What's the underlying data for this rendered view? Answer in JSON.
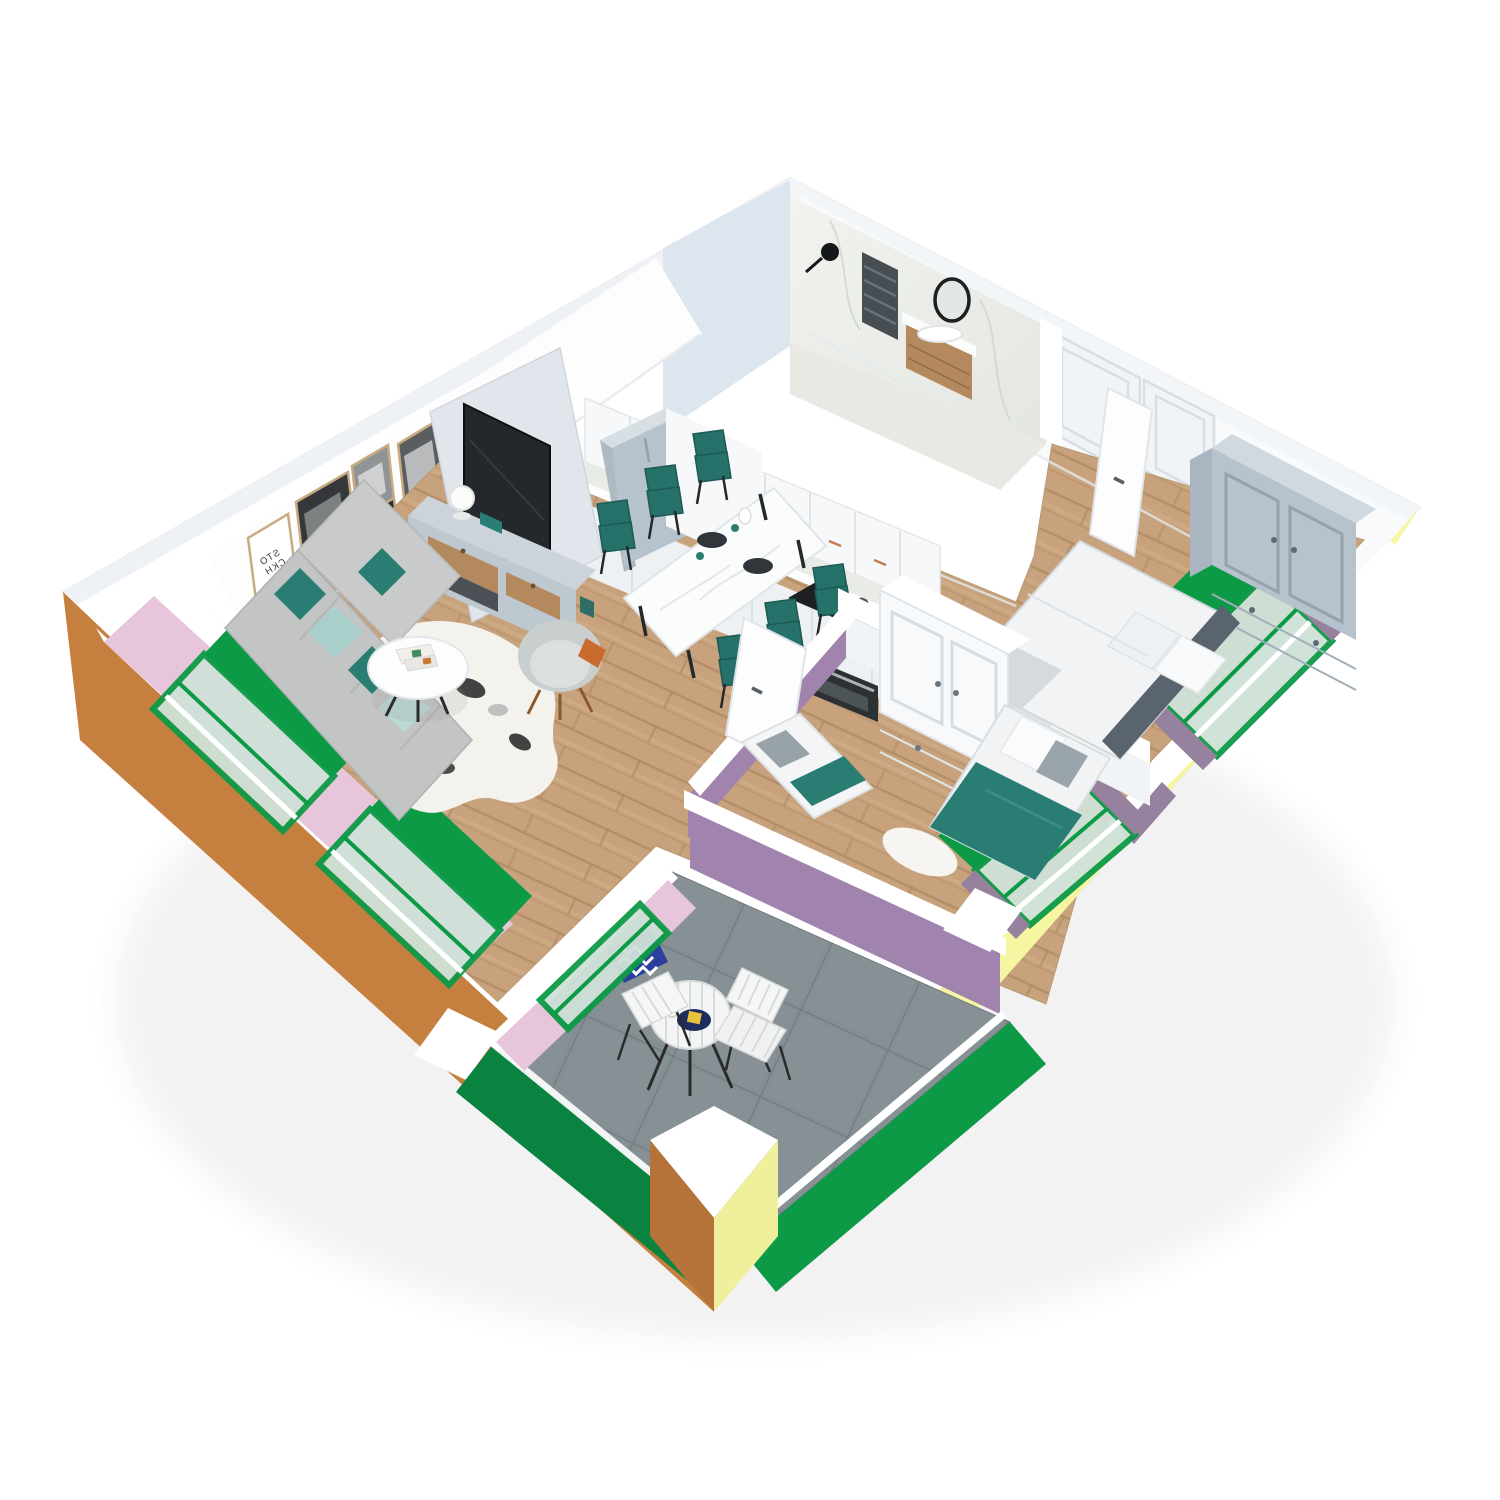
{
  "scene": {
    "kind": "3d-apartment-floorplan-render",
    "background": "#ffffff",
    "poster_lines": {
      "l1": "STO",
      "l2": "CKH",
      "l3": "OLM"
    }
  },
  "palette": {
    "bg": "#ffffff",
    "wall_white": "#ffffff",
    "wall_shade": "#f3f6f9",
    "wall_cool": "#dde6ee",
    "wall_interior": "#f8fafb",
    "partition": "#e0e6eb",
    "bath_floor": "#eae8e3",
    "wood_base": "#c7a27c",
    "wood_line": "#ad875f",
    "wood_furniture": "#b5895e",
    "tile_base": "#848e93",
    "tile_line": "#6f797d",
    "orange": "#c5803f",
    "orange_dark": "#b5733a",
    "yellow": "#f6f6a2",
    "yellow_dark": "#efef9c",
    "green": "#0d9a47",
    "green_dark": "#0a8340",
    "glass": "#cfe2d8",
    "pink": "#e7c5da",
    "purple": "#96819f",
    "purple_wall": "#a184ae",
    "teal": "#2a7d72",
    "teal_chair": "#26726a",
    "sofa": "#c3c5c4",
    "sofa_light": "#cdcfce",
    "furniture_gray": "#b6c2cc",
    "furniture_gray_light": "#d0d9df",
    "bed_linen": "#f1f3f5",
    "headboard": "#59646e",
    "tv_dark": "#23282c",
    "navy": "#1f2d5e",
    "chevron_blue": "#2b3f9e",
    "accent_yellow": "#e8c23a",
    "accent_orange": "#c96a2f"
  },
  "rooms": [
    {
      "name": "bathroom",
      "furniture": [
        "towel-radiator",
        "wall-lamp",
        "round-mirror",
        "vanity-with-sink"
      ],
      "finish": "marble walls"
    },
    {
      "name": "kitchen",
      "furniture": [
        "upper-cabinets",
        "base-cabinets",
        "cooktop",
        "oven",
        "sink",
        "tall-cabinet"
      ],
      "finish": "white cabinets, wood floor"
    },
    {
      "name": "dining-area",
      "furniture": [
        "marble-dining-table",
        "dining-chairs"
      ],
      "dining_chairs": 6
    },
    {
      "name": "living-room",
      "furniture": [
        "corner-sofa",
        "cushions",
        "coffee-table",
        "magazines",
        "cowhide-rug",
        "armchair",
        "tv",
        "media-console",
        "table-lamp",
        "gallery-posters"
      ],
      "posters": 5
    },
    {
      "name": "hallway",
      "furniture": [
        "entry-doors",
        "open-door-leaf"
      ]
    },
    {
      "name": "bedroom-1",
      "furniture": [
        "double-bed",
        "pillows",
        "wardrobe",
        "nightstand",
        "fur-rug",
        "french-balcony-window"
      ]
    },
    {
      "name": "bedroom-2",
      "furniture": [
        "single-bed",
        "daybed",
        "wardrobe",
        "nightstand",
        "fur-rug",
        "french-balcony-window"
      ]
    },
    {
      "name": "terrace",
      "furniture": [
        "bistro-table",
        "folding-chairs",
        "chevron-cushion",
        "serving-tray"
      ],
      "bistro_chairs": 2,
      "finish": "grey tile floor, green railings"
    }
  ]
}
